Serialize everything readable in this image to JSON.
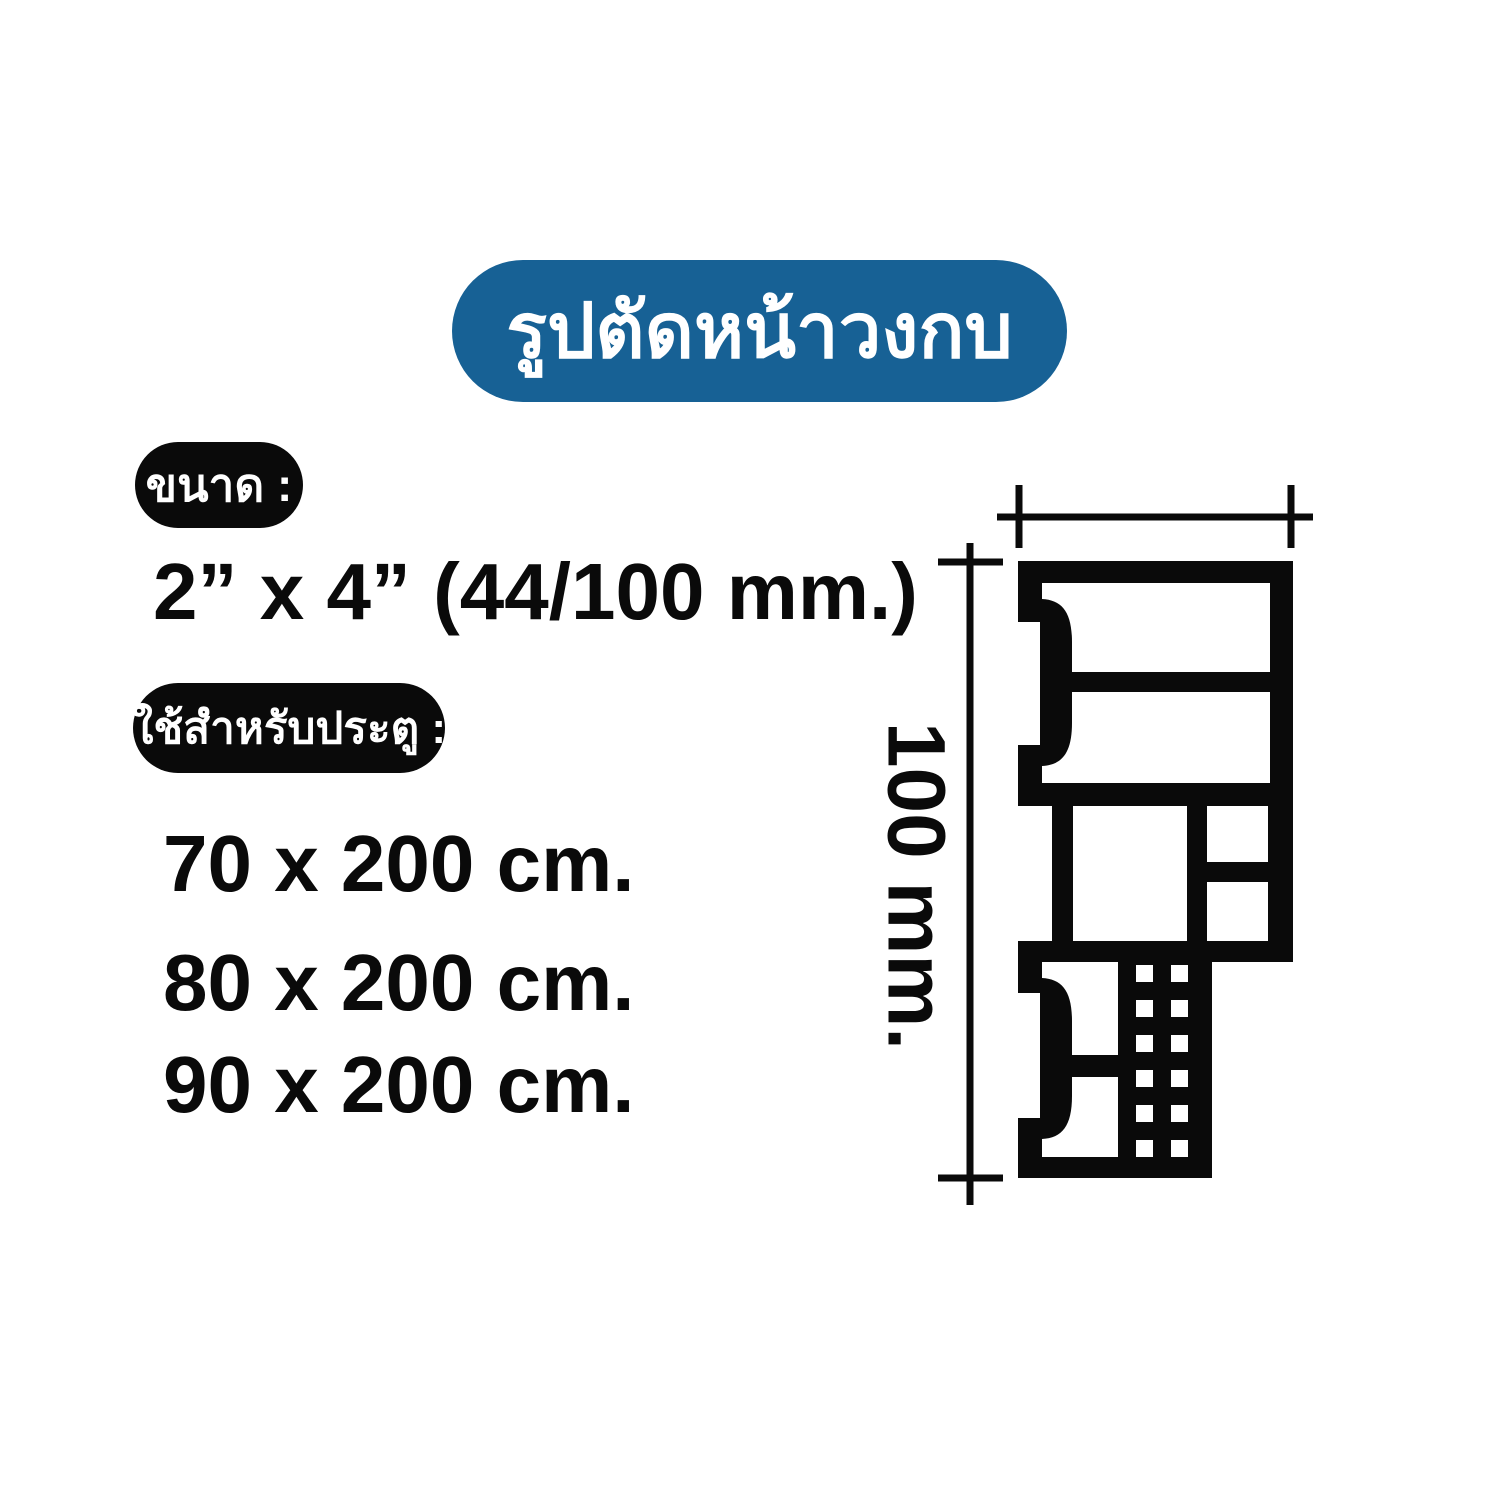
{
  "page": {
    "background_color": "#ffffff",
    "accent_color": "#176195",
    "ink_color": "#0a0a0a"
  },
  "title": {
    "text": "รูปตัดหน้าวงกบ"
  },
  "specs": {
    "size_label": "ขนาด :",
    "size_value": "2” x 4” (44/100 mm.)",
    "usage_label": "ใช้สำหรับประตู :",
    "door_sizes": [
      "70 x 200 cm.",
      "80 x 200 cm.",
      "90 x 200 cm."
    ]
  },
  "diagram": {
    "description": "door-frame profile cross-section",
    "height_label": "100 mm."
  }
}
